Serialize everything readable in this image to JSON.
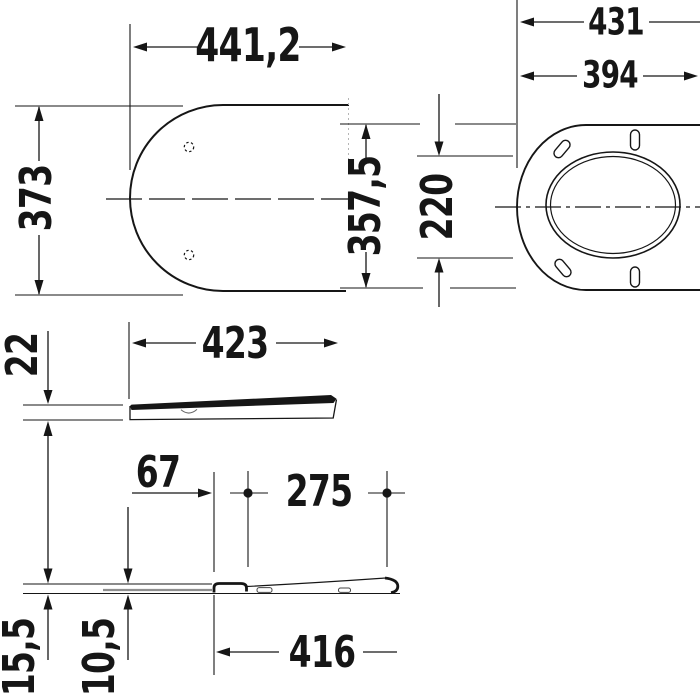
{
  "drawing_type": "technical-dimension-drawing",
  "colors": {
    "line": "#161616",
    "background": "#ffffff",
    "accent_gray": "#8f8f8f"
  },
  "views": {
    "lid_top": {
      "width": "441,2",
      "depth": "373"
    },
    "seat_top": {
      "outer_width": "431",
      "hinge_width": "394",
      "depth": "357,5",
      "opening_depth": "220"
    },
    "lid_side": {
      "length": "423",
      "thickness": "22"
    },
    "seat_side": {
      "hinge_offset": "67",
      "pivot_spacing": "275",
      "length": "416",
      "front_height": "15,5",
      "rear_height": "10,5"
    }
  }
}
